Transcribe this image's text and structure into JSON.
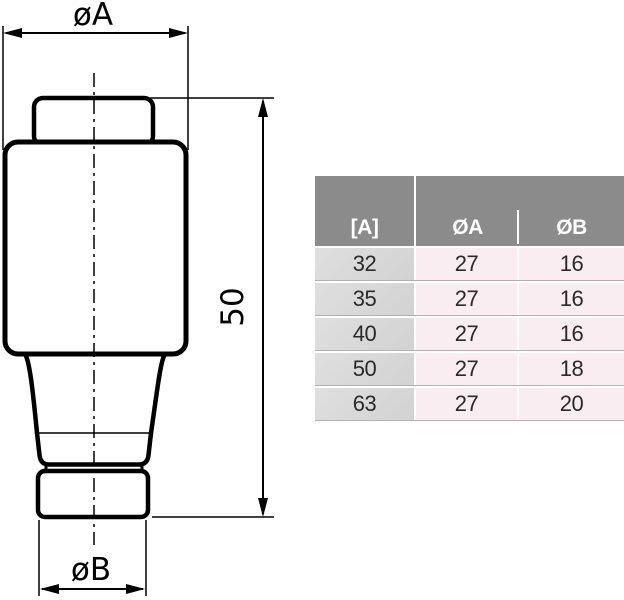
{
  "drawing": {
    "label_diameter_a": "øA",
    "label_height": "50",
    "label_diameter_b": "øB",
    "line_color": "#000000",
    "description": "Side view of a bottle fuse link with overall height 50 mm, body diameter øA and bottom cap diameter øB"
  },
  "table": {
    "headers": {
      "amps": "[A]",
      "dia_a": "ØA",
      "dia_b": "ØB"
    },
    "rows": [
      {
        "amps": "32",
        "dia_a": "27",
        "dia_b": "16"
      },
      {
        "amps": "35",
        "dia_a": "27",
        "dia_b": "16"
      },
      {
        "amps": "40",
        "dia_a": "27",
        "dia_b": "16"
      },
      {
        "amps": "50",
        "dia_a": "27",
        "dia_b": "18"
      },
      {
        "amps": "63",
        "dia_a": "27",
        "dia_b": "20"
      }
    ],
    "colors": {
      "header_bg": "#8b8b8b",
      "header_text": "#ffffff",
      "amps_col_bg": "#d6d6d6",
      "value_col_bg": "#f9edf2",
      "row_line": "#b3aeb1",
      "text": "#2a2a2a"
    }
  }
}
